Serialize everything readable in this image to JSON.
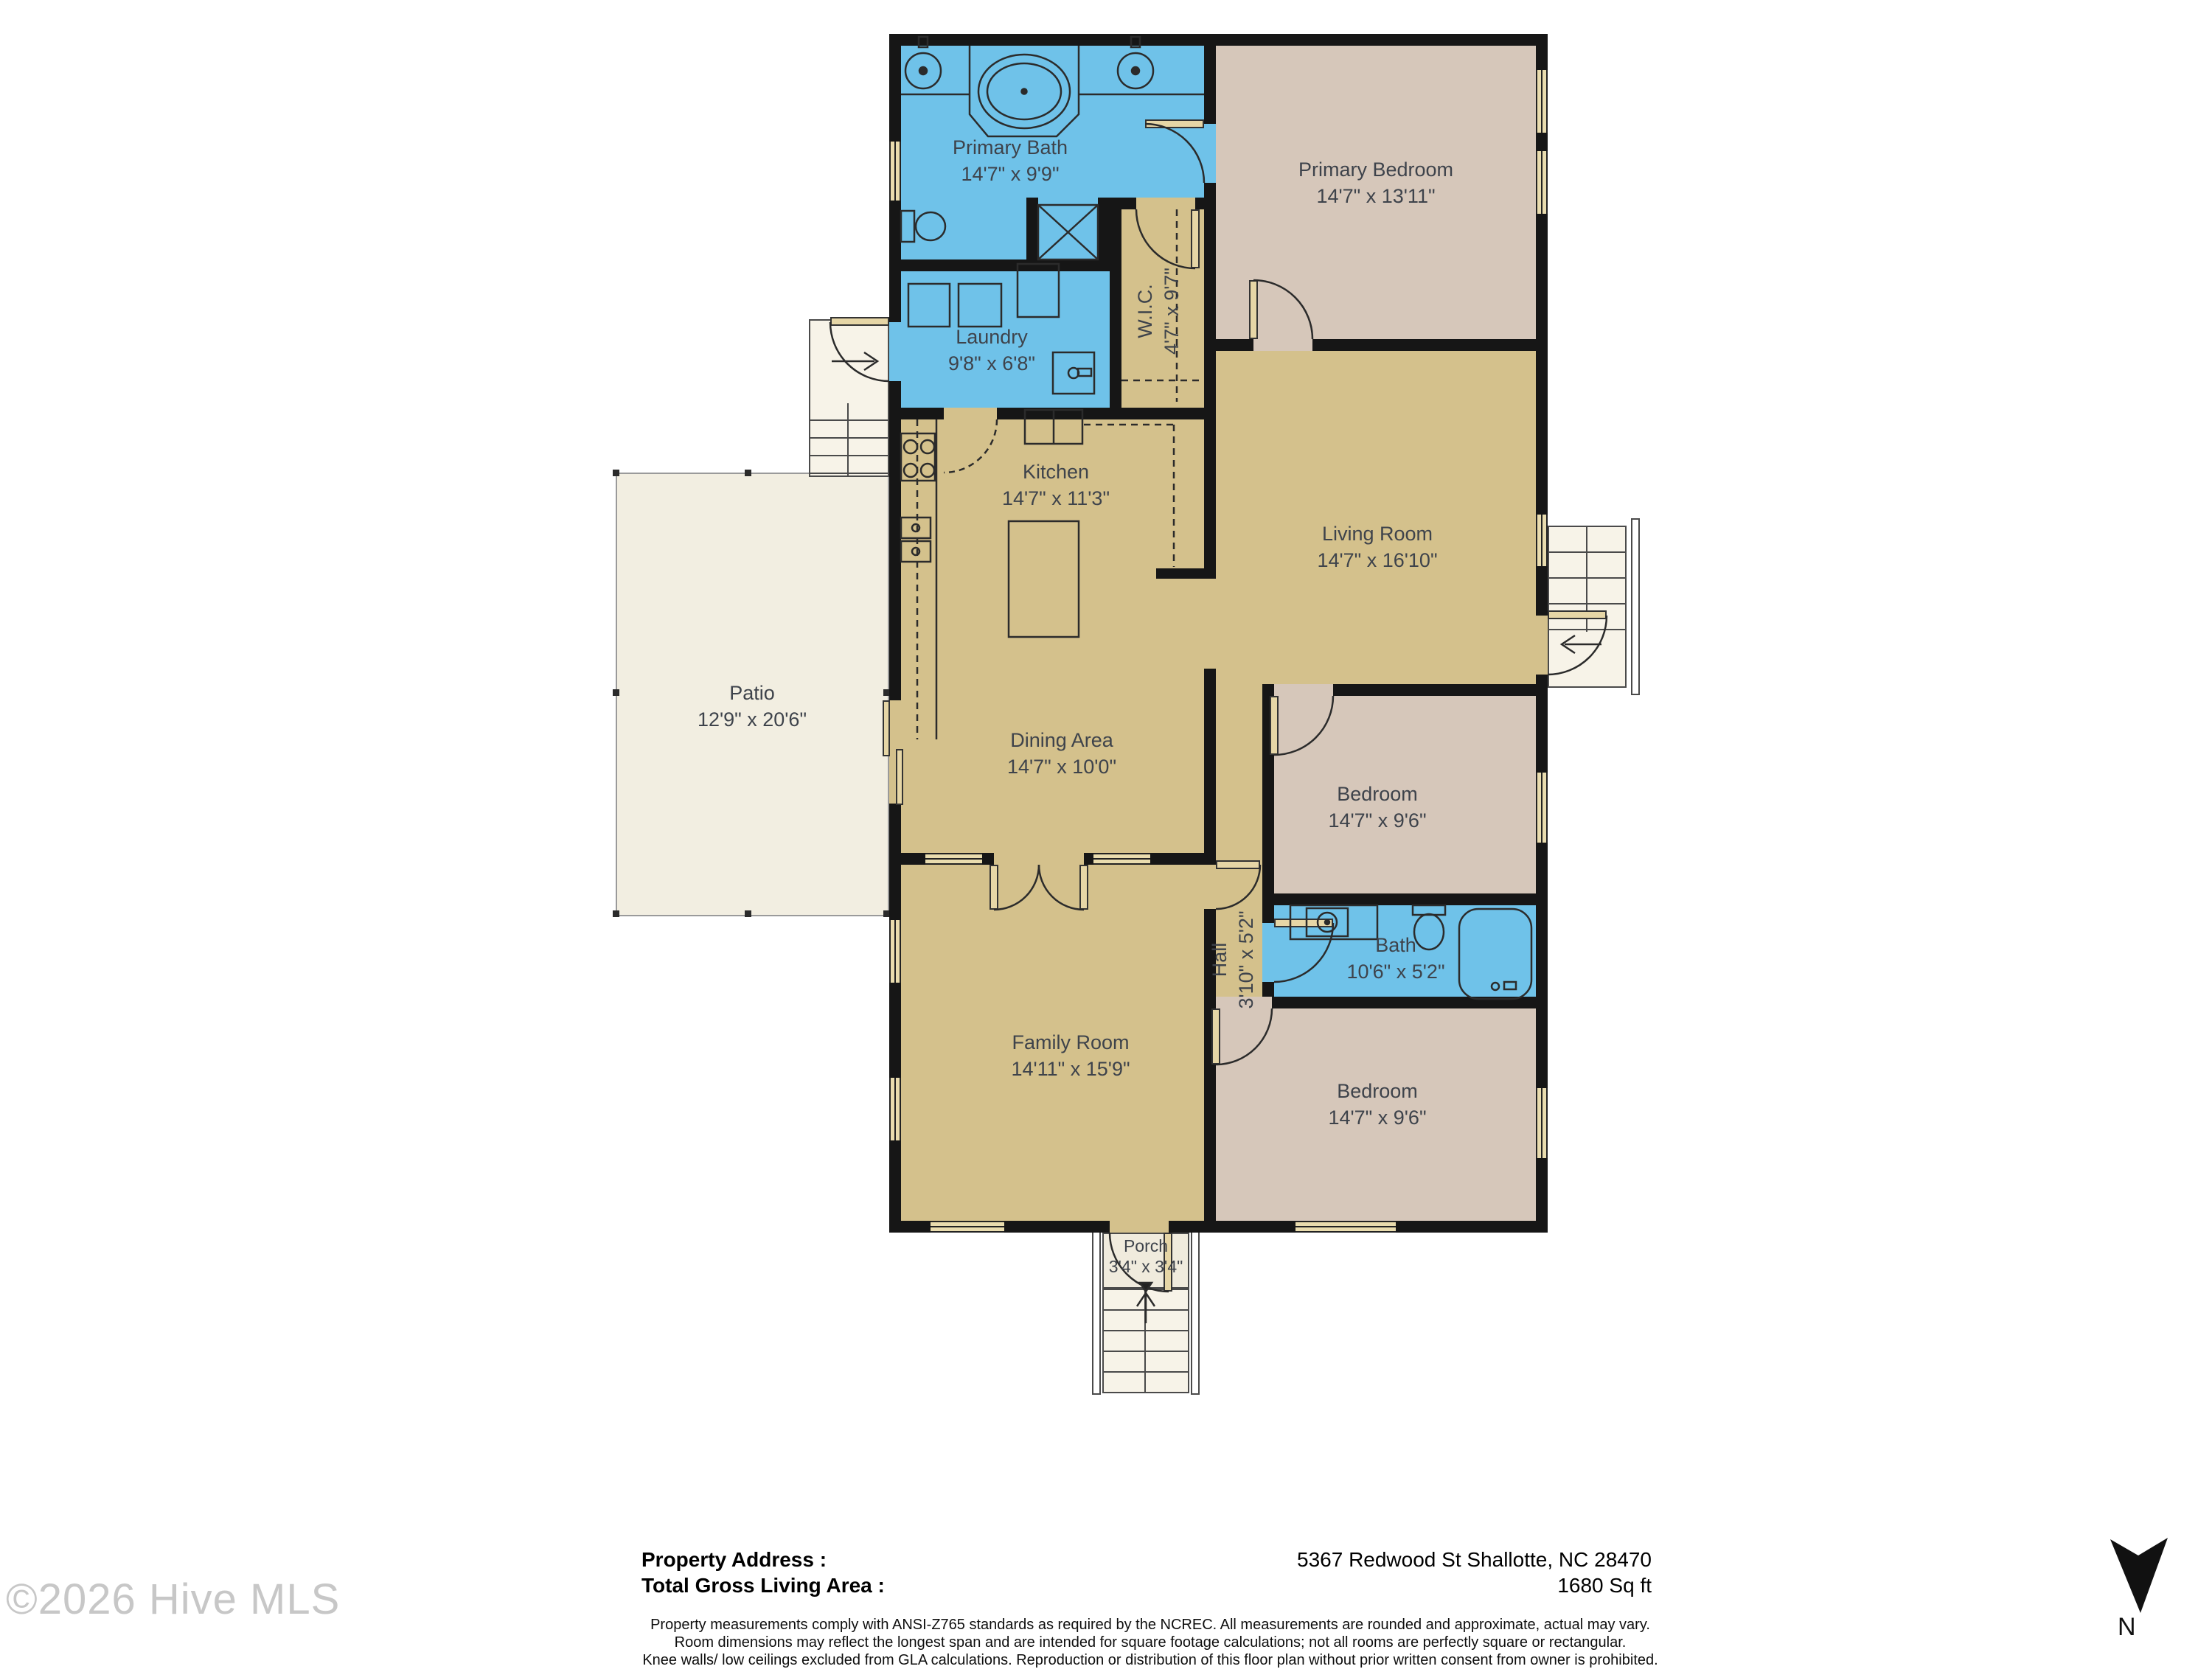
{
  "title": "Floor plan",
  "rooms": [
    {
      "name": "Primary Bath",
      "dims": "14'7\" x 9'9\""
    },
    {
      "name": "Primary Bedroom",
      "dims": "14'7\" x 13'11\""
    },
    {
      "name": "Laundry",
      "dims": "9'8\" x 6'8\""
    },
    {
      "name": "W.I.C.",
      "dims": "4'7\" x 9'7\""
    },
    {
      "name": "Kitchen",
      "dims": "14'7\" x 11'3\""
    },
    {
      "name": "Living Room",
      "dims": "14'7\" x 16'10\""
    },
    {
      "name": "Patio",
      "dims": "12'9\" x 20'6\""
    },
    {
      "name": "Dining Area",
      "dims": "14'7\" x 10'0\""
    },
    {
      "name": "Bedroom",
      "dims": "14'7\" x 9'6\""
    },
    {
      "name": "Hall",
      "dims": "3'10\" x 5'2\""
    },
    {
      "name": "Bath",
      "dims": "10'6\" x 5'2\""
    },
    {
      "name": "Family Room",
      "dims": "14'11\" x 15'9\""
    },
    {
      "name": "Bedroom",
      "dims": "14'7\" x 9'6\""
    },
    {
      "name": "Porch",
      "dims": "3'4\" x 3'4\""
    }
  ],
  "footer": {
    "property_address_label": "Property Address :",
    "property_address_value": "5367 Redwood St Shallotte, NC 28470",
    "gla_label": "Total Gross Living Area :",
    "gla_value": "1680 Sq ft",
    "disclaimer_lines": [
      "Property measurements comply with ANSI-Z765 standards as required by the NCREC. All measurements are rounded and approximate, actual may vary.",
      "Room dimensions may reflect the longest span and are intended for square footage calculations; not all rooms are perfectly square or rectangular.",
      "Knee walls/ low ceilings excluded from GLA calculations.  Reproduction or distribution of this floor plan without prior written consent from owner is prohibited."
    ]
  },
  "watermark": "©2026 Hive MLS",
  "compass": {
    "label": "N"
  },
  "colors": {
    "bath_blue": "#6fc2e9",
    "living_tan": "#d4c18c",
    "bedroom_mauve": "#d6c7ba",
    "patio_cream": "#f2eee1",
    "wall_black": "#161616",
    "label_text": "#3e434b",
    "watermark_gray": "#c7c7c7"
  }
}
